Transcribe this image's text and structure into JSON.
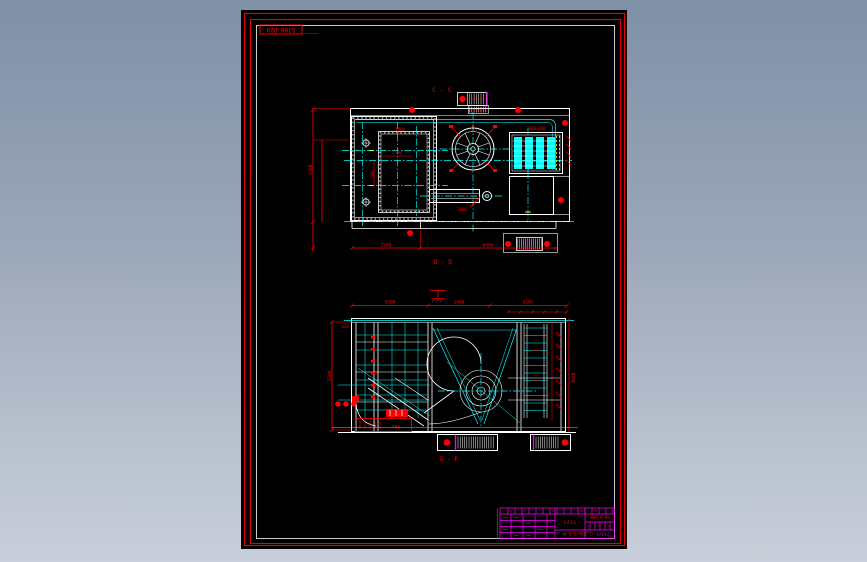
{
  "colors": {
    "background_top": "#7f90a7",
    "background_bottom": "#c8cfda",
    "paper": "#000000",
    "border_red": "#ff0000",
    "border_white": "#ffffff",
    "line_cyan": "#00ffff",
    "line_magenta": "#ff00ff",
    "line_yellow": "#ffff00"
  },
  "sheet": {
    "stamp": "SJ00-D29"
  },
  "plan_view": {
    "section_label_top": "C - C",
    "section_label_bottom": "D - D",
    "dim_left": "3300",
    "dim_room_top": "1800",
    "dim_room": "1500",
    "dim_room_v": "900",
    "dim_conveyor": "2000",
    "dim_tank": "2000×600",
    "dim_bottom_left": "1500",
    "dim_bottom_right": "6400"
  },
  "section_view": {
    "section_label": "E - E",
    "dim_col": "420",
    "dim_top_left": "5500",
    "dim_top_mid": "2400",
    "dim_top_right": "4100",
    "dim_left": "3300",
    "dim_right": "3000",
    "dim_box": "700"
  },
  "title_block": {
    "center_text": "????",
    "code_text": "68.H-OKB",
    "model_text": "G-J50/9.8-M",
    "qmarks": "?????"
  }
}
